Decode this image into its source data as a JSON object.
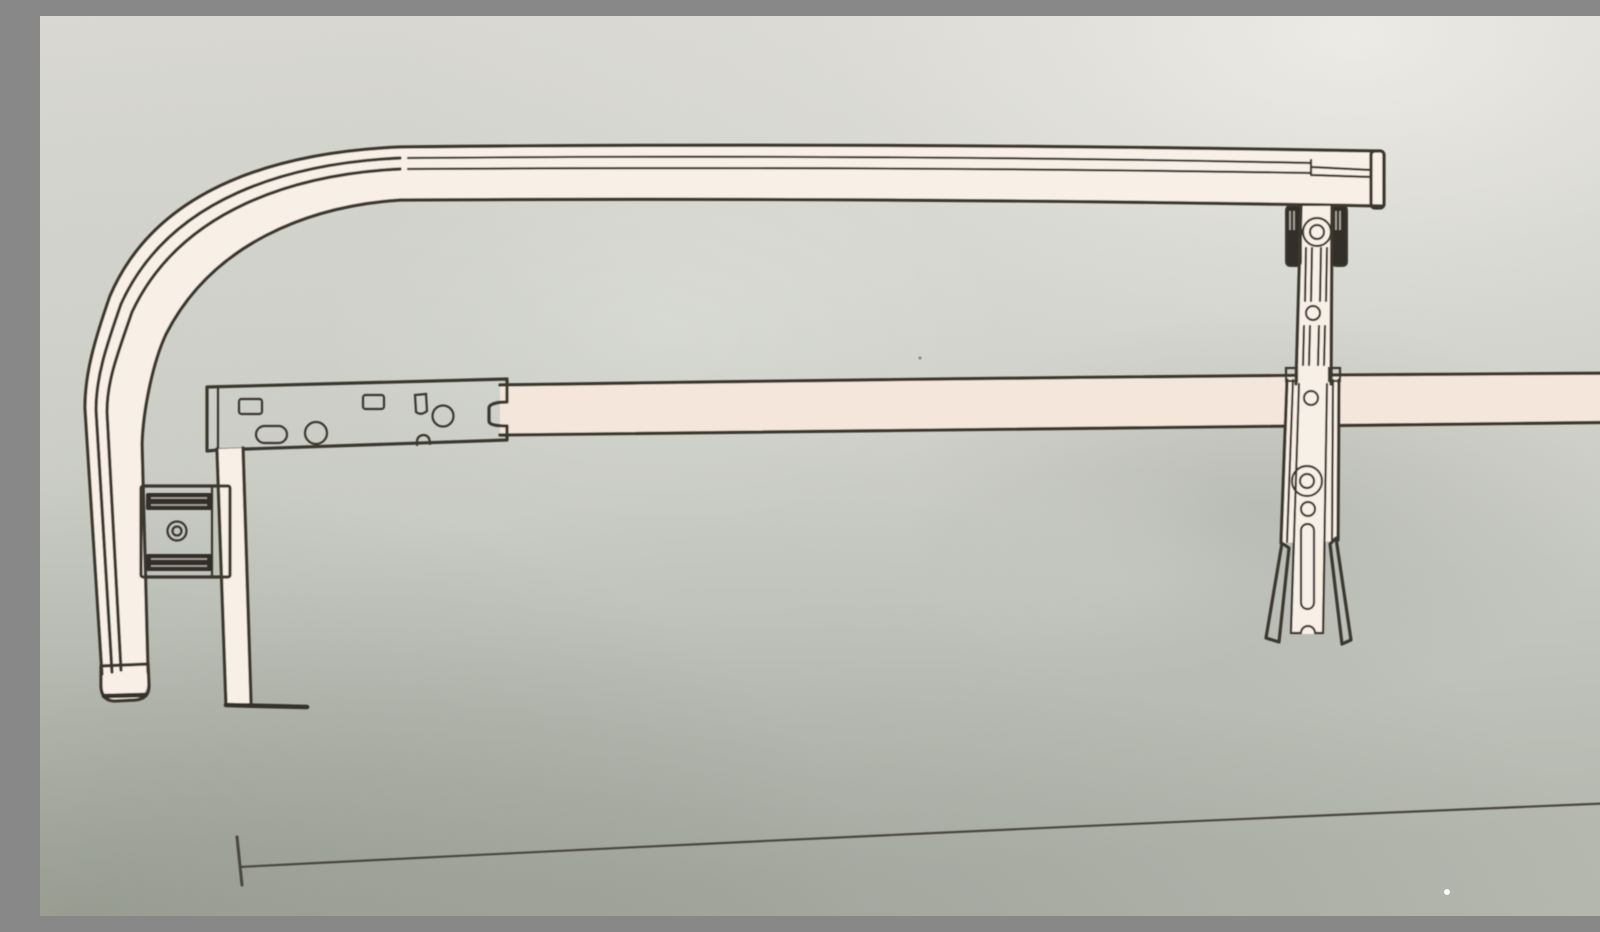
{
  "page": {
    "kind": "photographed-instruction-diagram",
    "description": "Photo of a printed black-line technical illustration showing an adjustable rack assembly: a curved top rail tube, a punched mounting plate on a long support rail, a clamp block, a drop bracket with a foot, an adjustable slotted upright with forked feet, and a baseline dimension line.",
    "visible_text": []
  },
  "colors": {
    "paper_top": "#d9d8d2",
    "paper_mid": "#cdd0c9",
    "paper_bottom": "#b5b8af",
    "corner_highlight": "#efede8",
    "ink": "#3b372e",
    "ink_soft": "#4a463c",
    "part_fill": "#f8efe6",
    "part_fill_warm": "#f5e6db",
    "hardware_dark": "#322f29",
    "etch_light": "#d6cdc1"
  },
  "diagram": {
    "parts": [
      {
        "id": "top-rail-tube",
        "label": "Curved top rail tube",
        "notes": "horizontal tube that bends 90 degrees down at the left and ends in a rounded cap"
      },
      {
        "id": "top-rail-end-cap",
        "label": "End cap on right end of top rail"
      },
      {
        "id": "mounting-plate",
        "label": "Punched mounting plate",
        "notes": "two rectangular holes, two round holes, one oval slot, keyed notch on right edge"
      },
      {
        "id": "support-rail",
        "label": "Straight support rail running off the right edge of the photo"
      },
      {
        "id": "drop-bracket",
        "label": "Drop bracket with horizontal foot at bottom left"
      },
      {
        "id": "side-clamp",
        "label": "Clamp block with two dark pads and a center bolt hole"
      },
      {
        "id": "upright-assembly",
        "label": "Adjustable upright strut",
        "notes": "two dark clamp lugs at top, washer with bolt hole, adjustment slots and holes, long slot, forked feet at bottom"
      },
      {
        "id": "dimension-line",
        "label": "Baseline dimension line with end tick at lower left"
      }
    ]
  }
}
